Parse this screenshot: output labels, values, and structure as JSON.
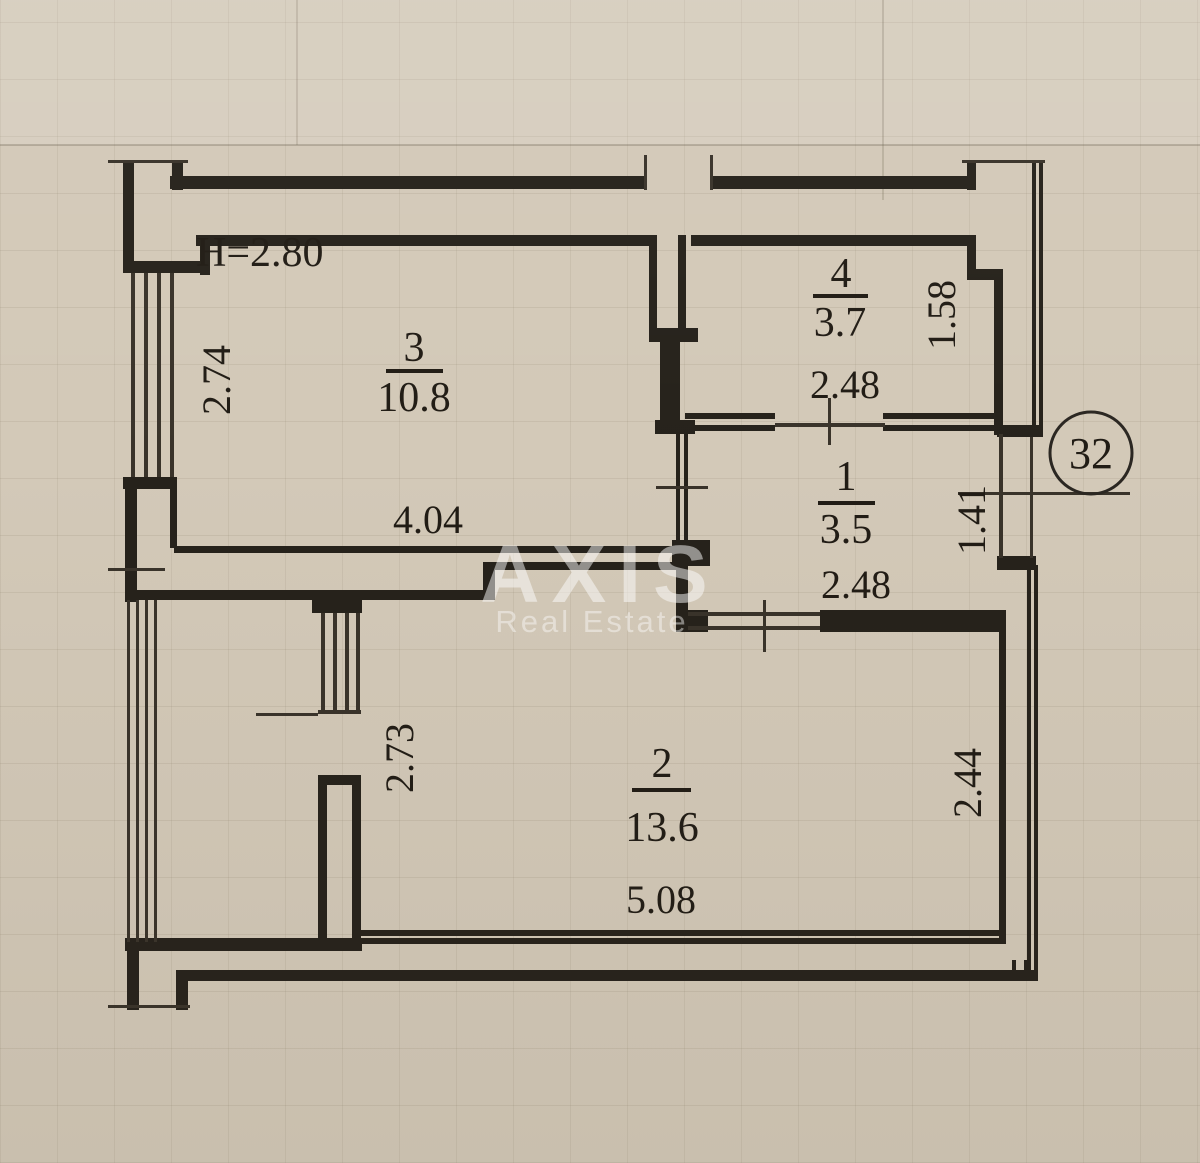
{
  "floor_plan": {
    "ceiling_height_note": "H=2.80",
    "apartment_number": "32",
    "rooms": [
      {
        "number": "3",
        "area": "10.8",
        "width_label": "4.04",
        "height_label": "2.74"
      },
      {
        "number": "4",
        "area": "3.7",
        "width_label": "2.48",
        "height_label": "1.58"
      },
      {
        "number": "1",
        "area": "3.5",
        "width_label": "2.48",
        "height_label": "1.41"
      },
      {
        "number": "2",
        "area": "13.6",
        "width_label": "5.08",
        "height_label": "2.44"
      }
    ],
    "balcony": {
      "depth_label": "2.73"
    },
    "watermark": {
      "brand": "AXIS",
      "tagline": "Real Estate"
    },
    "colors": {
      "paper": "#d3c9b8",
      "ink": "#26221b",
      "watermark_text": "#ffffff"
    }
  }
}
